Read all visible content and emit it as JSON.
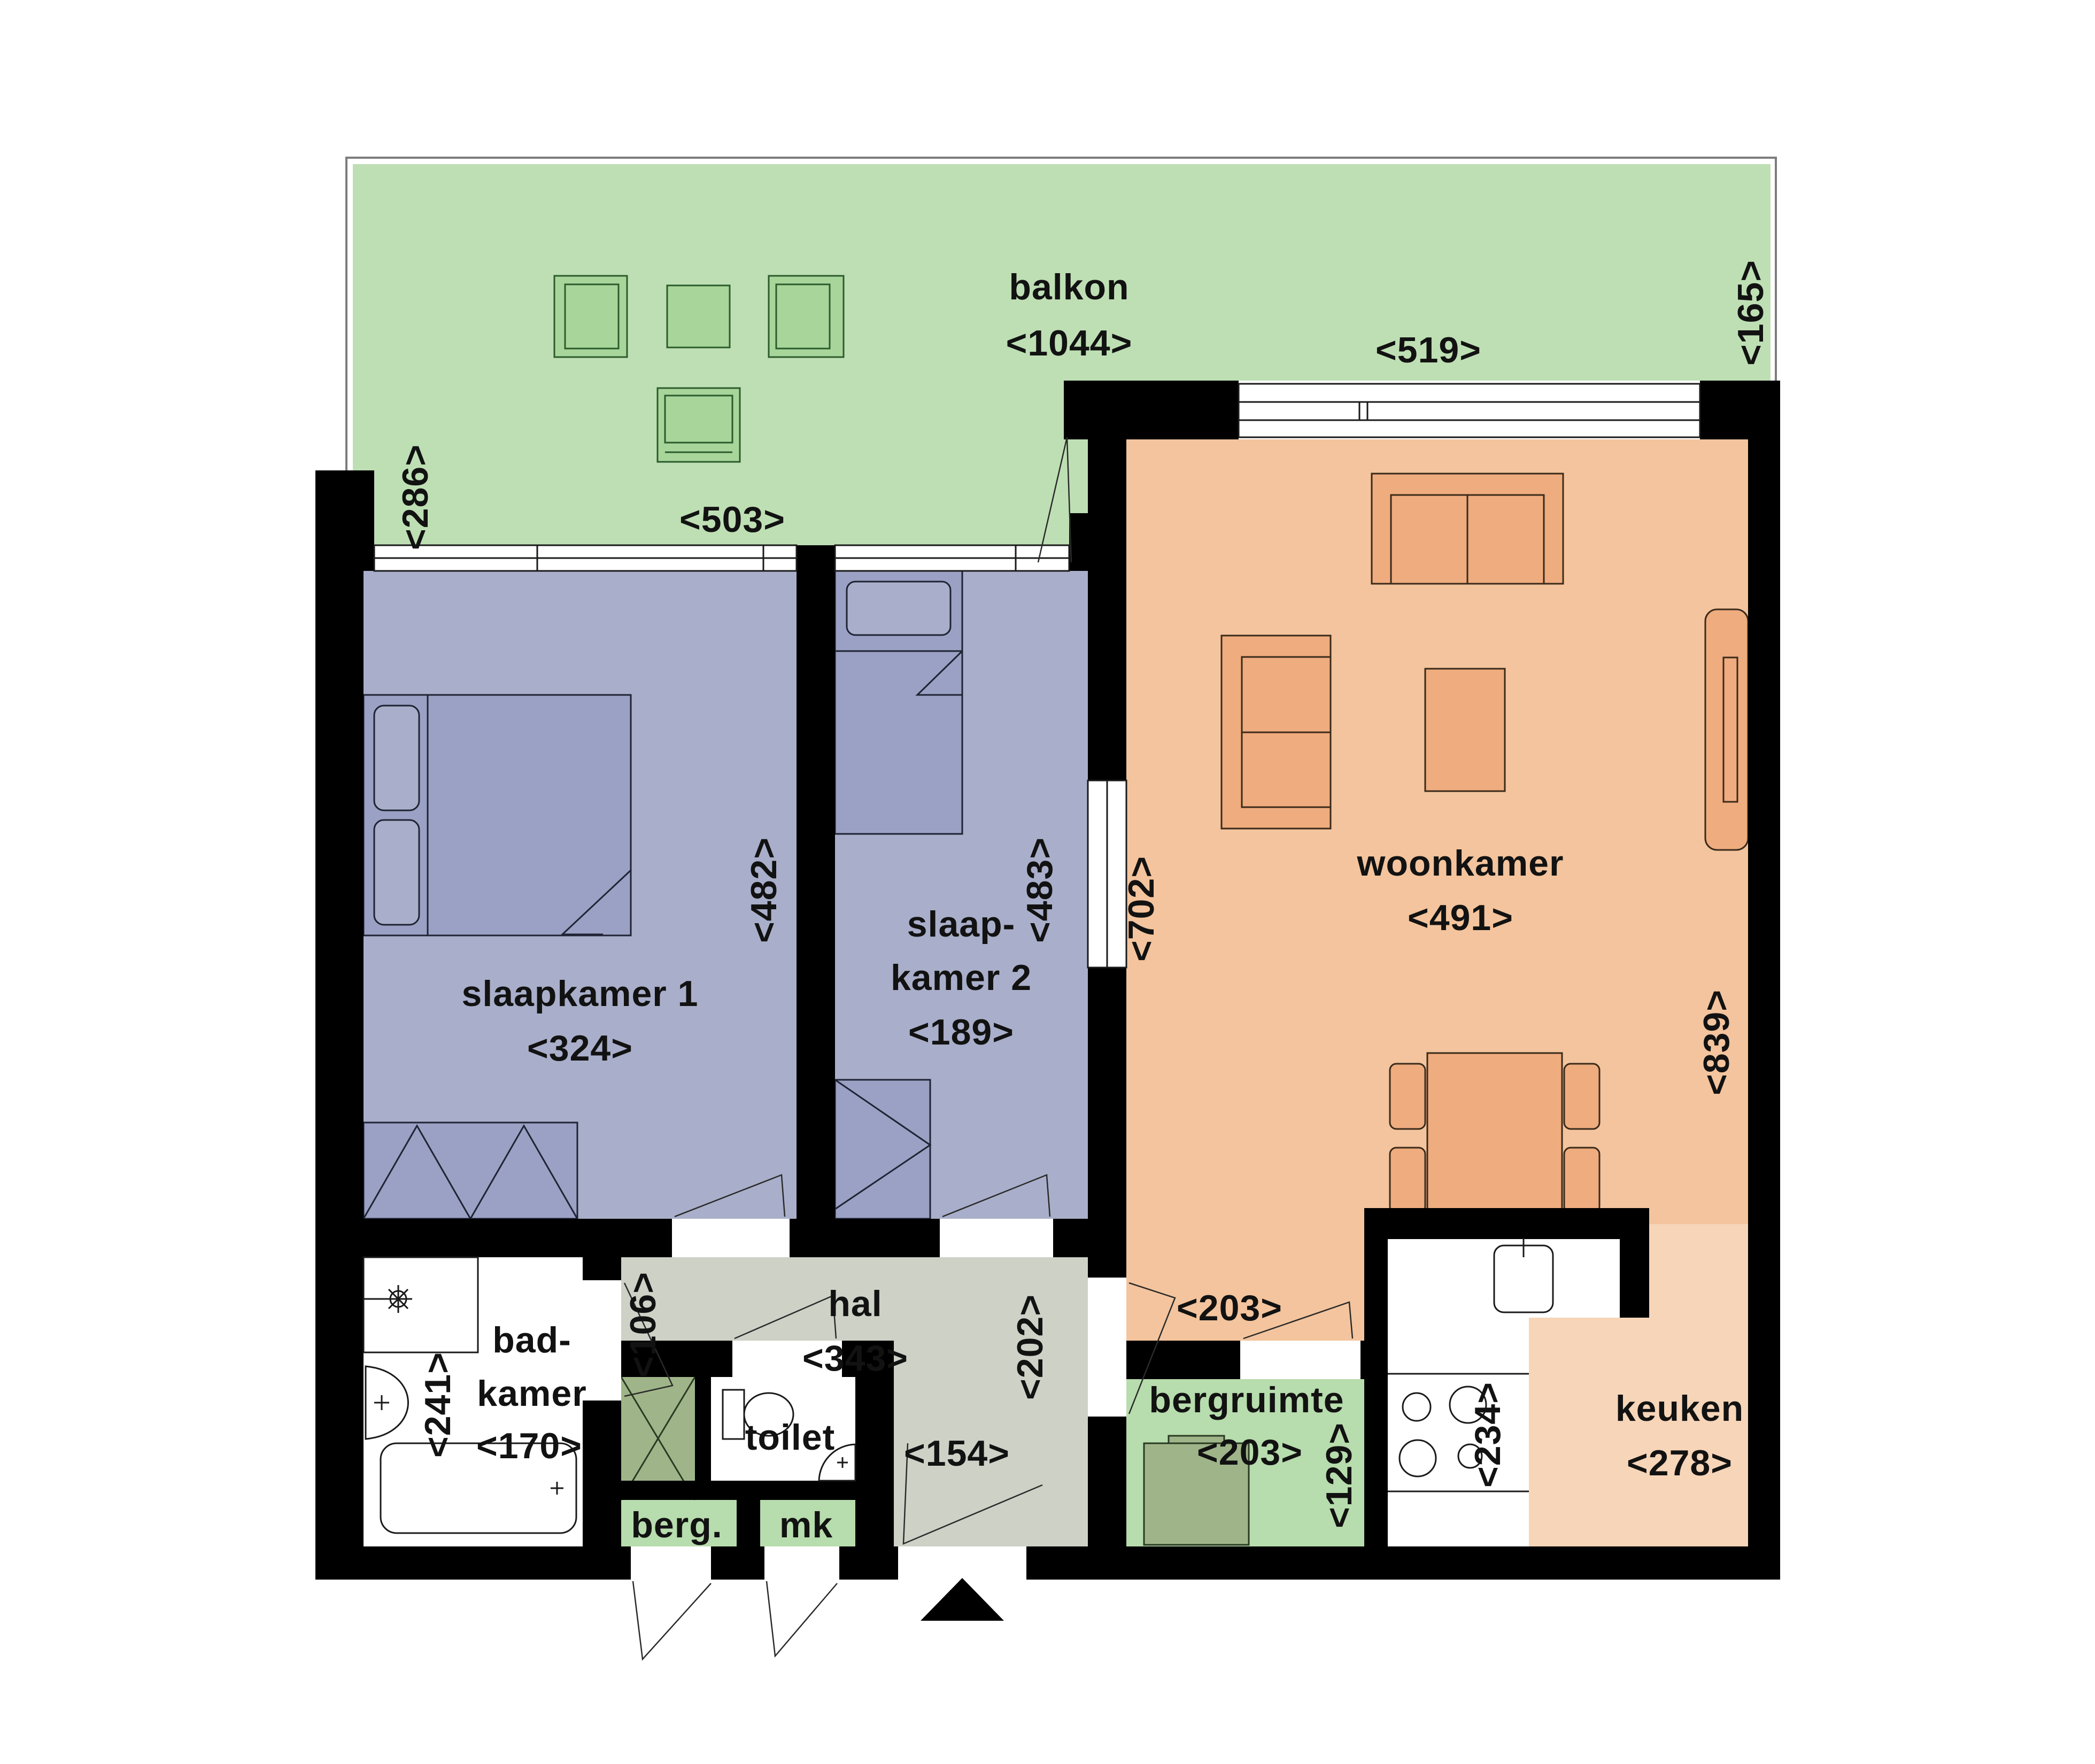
{
  "floorplan": {
    "kind": "apartment-floorplan",
    "language": "nl",
    "rooms": {
      "balkon": {
        "label": "balkon",
        "size": "<1044>"
      },
      "woonkamer": {
        "label": "woonkamer",
        "size": "<491>"
      },
      "slaapkamer1": {
        "label": "slaapkamer 1",
        "size": "<324>"
      },
      "slaapkamer2": {
        "label_line1": "slaap-",
        "label_line2": "kamer 2",
        "size": "<189>"
      },
      "hal": {
        "label": "hal",
        "size": "<343>"
      },
      "badkamer": {
        "label_line1": "bad-",
        "label_line2": "kamer",
        "size": "<170>"
      },
      "toilet": {
        "label": "toilet"
      },
      "berg": {
        "label": "berg."
      },
      "mk": {
        "label": "mk"
      },
      "bergruimte": {
        "label": "bergruimte",
        "size": "<203>"
      },
      "keuken": {
        "label": "keuken",
        "size": "<278>"
      }
    },
    "dims": {
      "balkon_depth_left": "<286>",
      "balkon_depth_right": "<165>",
      "balkon_bottom_left": "<503>",
      "woonkamer_window": "<519>",
      "slaapkamer1_depth": "<482>",
      "slaapkamer2_depth": "<483>",
      "woonkamer_depth_left": "<702>",
      "woonkamer_depth_right": "<839>",
      "woonkamer_bottom": "<203>",
      "badkamer_depth": "<241>",
      "badkamer_door": "<106>",
      "hal_right": "<202>",
      "hal_bottom": "<154>",
      "bergruimte_depth": "<129>",
      "keuken_left": "<234>"
    },
    "colors": {
      "balcony_green": "#bedfb4",
      "balcony_furniture": "#a8d69a",
      "bedroom_purple": "#a9afca",
      "bedroom_furniture": "#9aa1c4",
      "livingroom_orange": "#f3c49d",
      "livingroom_furniture": "#efac7e",
      "kitchen_orange": "#f7d5b8",
      "hall_gray": "#cdd1c6",
      "storage_green": "#b7dcad",
      "appliance_green": "#9fb589",
      "wall_black": "#000000",
      "fixture_white": "#ffffff"
    }
  }
}
